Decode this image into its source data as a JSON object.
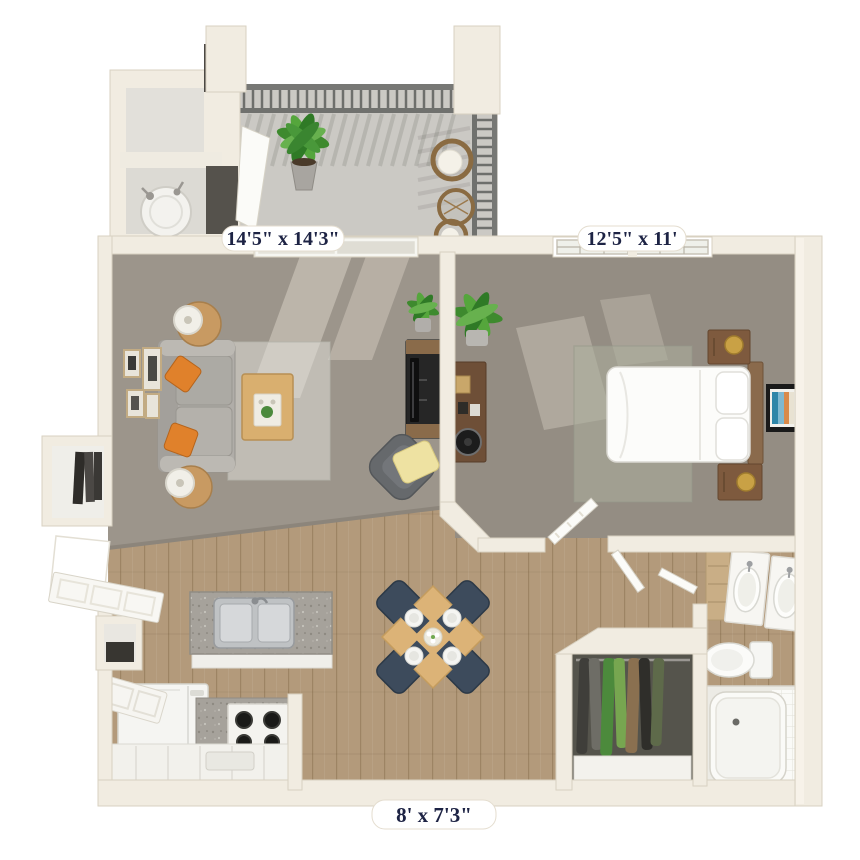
{
  "floorplan": {
    "labels": {
      "living_room": "14'5\" x 14'3\"",
      "bedroom": "12'5\" x 11'",
      "kitchen_dining": "8' x 7'3\""
    },
    "palette": {
      "background": "#ffffff",
      "wall": "#f1ece1",
      "wall_edge": "#d8d1c1",
      "carpet_living": "#9c958b",
      "carpet_bedroom": "#948d83",
      "wood_floor": "#b39a7b",
      "balcony_floor": "#cbc9c4",
      "railing": "#6e6f6c",
      "sofa_gray": "#b0ada8",
      "accent_orange": "#e0812b",
      "accent_navy": "#3d4b5c",
      "accent_yellow": "#eee2a2",
      "light_wood": "#dcb377",
      "dark_wood": "#7e5a3e",
      "granite": "#a6a29b",
      "fixture_white": "#f7f6f2",
      "plant_green": "#4c8a3c",
      "label_text": "#1d2344"
    }
  }
}
